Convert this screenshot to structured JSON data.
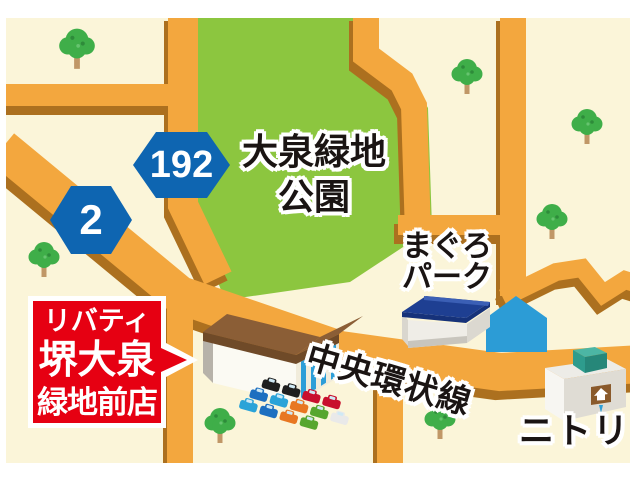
{
  "park": {
    "name_line1": "大泉緑地",
    "name_line2": "公園"
  },
  "route_signs": {
    "route_192": "192",
    "route_2": "2"
  },
  "places": {
    "maguro_park_line1": "まぐろ",
    "maguro_park_line2": "パーク",
    "nitori": "ニトリ"
  },
  "roads": {
    "main_road_name": "中央環状線"
  },
  "store_callout": {
    "line1": "リバティ",
    "line2": "堺大泉",
    "line3": "緑地前店"
  },
  "colors": {
    "map_background": "#FBF5D9",
    "park_green": "#8CC63F",
    "road_orange": "#F3A73E",
    "road_shadow_brown": "#AC701F",
    "route_sign_blue": "#0E65B1",
    "callout_red": "#E60012",
    "landmark_blue": "#2C9CD6",
    "tree_green": "#3FAE49"
  }
}
